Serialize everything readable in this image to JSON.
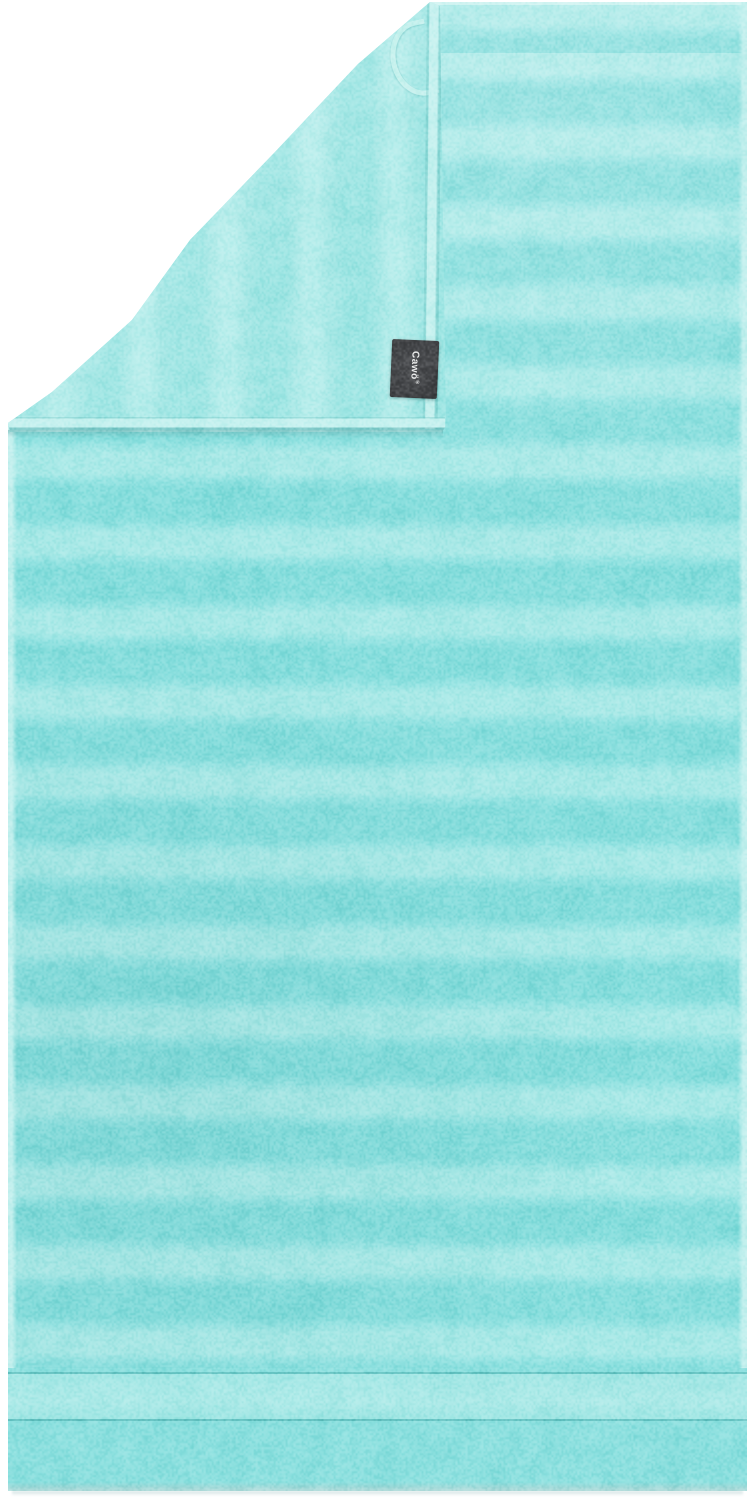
{
  "scene": {
    "description": "Product photo of an aqua turquoise striped terry towel with its top-left corner folded over, showing the reverse side, a hanging loop and a sewn-in brand label",
    "brand_label": {
      "text": "Cawö",
      "registered_mark": "®"
    },
    "colors": {
      "background": "#ffffff",
      "terry_base": "#87dedd",
      "terry_alt": "#8de0df",
      "velour_stripe": "#a9e9e7",
      "flap_base": "#a0e6e4",
      "flap_stripe_light": "#b6edeb",
      "hem_trim": "#c6f1ef",
      "seam": "#3ca5a5",
      "label_background": "#45474a",
      "label_text_color": "#e9eaea",
      "bottom_shadow": "#8cb4b6"
    }
  }
}
